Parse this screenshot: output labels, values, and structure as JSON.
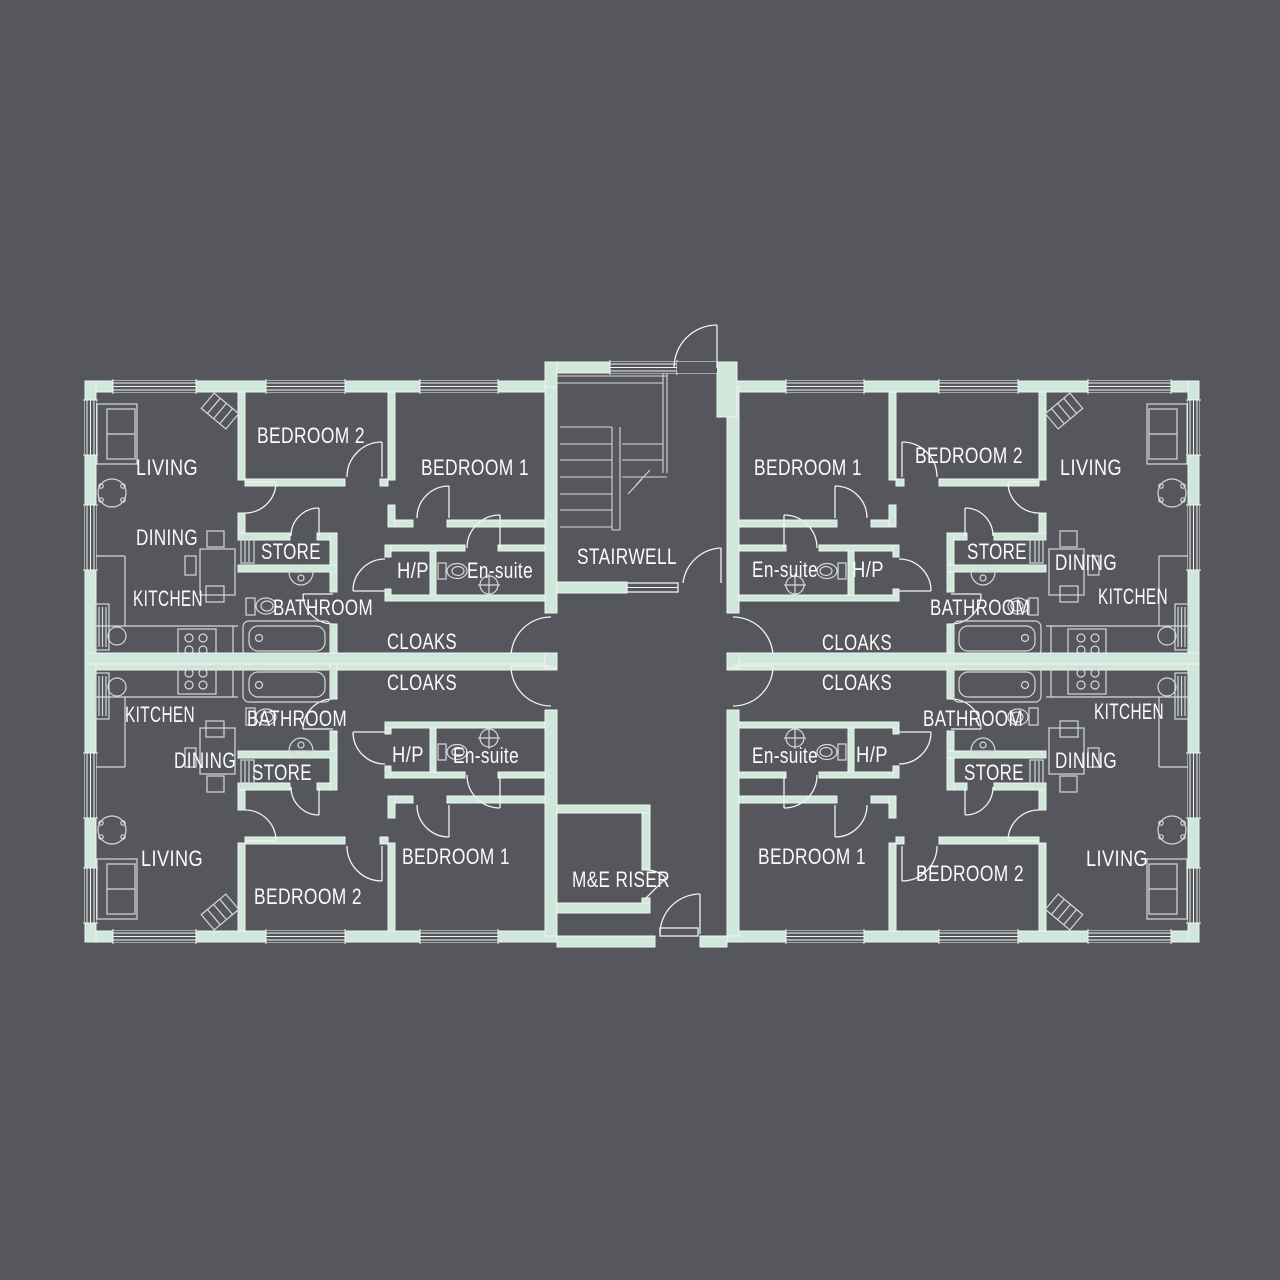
{
  "title": "Apartment block floor plan",
  "colors": {
    "background": "#55575c",
    "wall": "#cfe8db",
    "line": "#f0f3f1",
    "furniture": "#d6d9da",
    "text": "#fafbfa"
  },
  "floorplan": {
    "core_labels": [
      {
        "text": "STAIRWELL",
        "x": 627,
        "y": 564,
        "w": 100
      },
      {
        "text": "M&E RISER",
        "x": 621,
        "y": 887,
        "w": 98
      }
    ],
    "apartment_top_left": [
      {
        "text": "LIVING",
        "x": 167,
        "y": 475,
        "w": 62
      },
      {
        "text": "BEDROOM 2",
        "x": 311,
        "y": 443,
        "w": 108
      },
      {
        "text": "BEDROOM 1",
        "x": 475,
        "y": 475,
        "w": 108
      },
      {
        "text": "DINING",
        "x": 167,
        "y": 545,
        "w": 62
      },
      {
        "text": "KITCHEN",
        "x": 168,
        "y": 606,
        "w": 70
      },
      {
        "text": "STORE",
        "x": 291,
        "y": 559,
        "w": 60
      },
      {
        "text": "BATHROOM",
        "x": 323,
        "y": 615,
        "w": 100
      },
      {
        "text": "H/P",
        "x": 413,
        "y": 578,
        "w": 32
      },
      {
        "text": "En-suite",
        "x": 500,
        "y": 578,
        "w": 66
      },
      {
        "text": "CLOAKS",
        "x": 422,
        "y": 649,
        "w": 70
      }
    ],
    "apartment_top_right": [
      {
        "text": "BEDROOM 1",
        "x": 808,
        "y": 475,
        "w": 108
      },
      {
        "text": "BEDROOM 2",
        "x": 969,
        "y": 463,
        "w": 108
      },
      {
        "text": "LIVING",
        "x": 1091,
        "y": 475,
        "w": 62
      },
      {
        "text": "En-suite",
        "x": 785,
        "y": 577,
        "w": 66
      },
      {
        "text": "H/P",
        "x": 868,
        "y": 577,
        "w": 32
      },
      {
        "text": "STORE",
        "x": 997,
        "y": 559,
        "w": 60
      },
      {
        "text": "DINING",
        "x": 1086,
        "y": 570,
        "w": 62
      },
      {
        "text": "KITCHEN",
        "x": 1133,
        "y": 604,
        "w": 70
      },
      {
        "text": "BATHROOM",
        "x": 980,
        "y": 615,
        "w": 100
      },
      {
        "text": "CLOAKS",
        "x": 857,
        "y": 650,
        "w": 70
      }
    ],
    "apartment_bottom_left": [
      {
        "text": "KITCHEN",
        "x": 160,
        "y": 722,
        "w": 70
      },
      {
        "text": "BATHROOM",
        "x": 297,
        "y": 726,
        "w": 100
      },
      {
        "text": "DINING",
        "x": 205,
        "y": 768,
        "w": 62
      },
      {
        "text": "STORE",
        "x": 282,
        "y": 780,
        "w": 60
      },
      {
        "text": "H/P",
        "x": 408,
        "y": 762,
        "w": 32
      },
      {
        "text": "En-suite",
        "x": 486,
        "y": 763,
        "w": 66
      },
      {
        "text": "CLOAKS",
        "x": 422,
        "y": 690,
        "w": 70
      },
      {
        "text": "LIVING",
        "x": 172,
        "y": 866,
        "w": 62
      },
      {
        "text": "BEDROOM 2",
        "x": 308,
        "y": 904,
        "w": 108
      },
      {
        "text": "BEDROOM 1",
        "x": 456,
        "y": 864,
        "w": 108
      }
    ],
    "apartment_bottom_right": [
      {
        "text": "En-suite",
        "x": 785,
        "y": 763,
        "w": 66
      },
      {
        "text": "H/P",
        "x": 872,
        "y": 762,
        "w": 32
      },
      {
        "text": "BATHROOM",
        "x": 973,
        "y": 726,
        "w": 100
      },
      {
        "text": "STORE",
        "x": 994,
        "y": 780,
        "w": 60
      },
      {
        "text": "DINING",
        "x": 1086,
        "y": 768,
        "w": 62
      },
      {
        "text": "KITCHEN",
        "x": 1129,
        "y": 719,
        "w": 70
      },
      {
        "text": "CLOAKS",
        "x": 857,
        "y": 690,
        "w": 70
      },
      {
        "text": "BEDROOM 1",
        "x": 812,
        "y": 864,
        "w": 108
      },
      {
        "text": "BEDROOM 2",
        "x": 970,
        "y": 881,
        "w": 108
      },
      {
        "text": "LIVING",
        "x": 1117,
        "y": 866,
        "w": 62
      }
    ]
  }
}
